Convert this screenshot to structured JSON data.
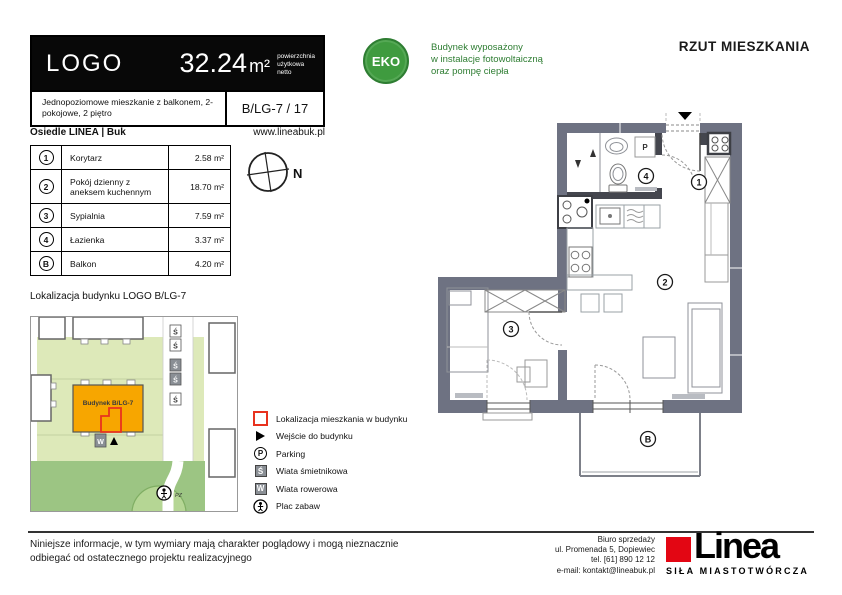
{
  "header": {
    "logo_text": "LOGO",
    "area": "32.24",
    "area_unit": "m²",
    "area_note_line1": "powierzchnia",
    "area_note_line2": "użytkowa",
    "area_note_line3": "netto",
    "description": "Jednopoziomowe mieszkanie z balkonem, 2-pokojowe, 2 piętro",
    "unit_code": "B/LG-7 / 17",
    "estate_name": "Osiedle LINEA | Buk",
    "website": "www.lineabuk.pl"
  },
  "eco": {
    "badge_text": "EKO",
    "line1": "Budynek wyposażony",
    "line2": "w instalacje fotowoltaiczną",
    "line3": "oraz pompę ciepła"
  },
  "plan_header": {
    "title": "RZUT MIESZKANIA"
  },
  "rooms_table": {
    "rows": [
      {
        "no": "1",
        "name": "Korytarz",
        "area": "2.58 m²"
      },
      {
        "no": "2",
        "name": "Pokój dzienny z aneksem kuchennym",
        "area": "18.70 m²"
      },
      {
        "no": "3",
        "name": "Sypialnia",
        "area": "7.59 m²"
      },
      {
        "no": "4",
        "name": "Łazienka",
        "area": "3.37 m²"
      },
      {
        "no": "B",
        "name": "Balkon",
        "area": "4.20 m²"
      }
    ]
  },
  "compass": {
    "north_label": "N"
  },
  "site_map": {
    "section_title": "Lokalizacja budynku  LOGO B/LG-7",
    "building_label": "Budynek B/LG-7",
    "waste_shelter_label": "Ś",
    "bike_shelter_label": "W",
    "playground_label": "PZ"
  },
  "legend": {
    "parking_icon_letter": "P",
    "waste_icon_letter": "Ś",
    "bike_icon_letter": "W",
    "items": [
      {
        "label": "Lokalizacja mieszkania w budynku"
      },
      {
        "label": "Wejście do budynku"
      },
      {
        "label": "Parking"
      },
      {
        "label": "Wiata śmietnikowa"
      },
      {
        "label": "Wiata rowerowa"
      },
      {
        "label": "Plac zabaw"
      }
    ]
  },
  "floor_plan": {
    "badge_corridor": "1",
    "badge_living": "2",
    "badge_bedroom": "3",
    "badge_bathroom": "4",
    "badge_balcony": "B",
    "washing_machine_label": "P"
  },
  "footer": {
    "disclaimer_line1": "Niniejsze informacje, w tym wymiary mają charakter poglądowy i mogą nieznacznie",
    "disclaimer_line2": "odbiegać od ostatecznego projektu realizacyjnego",
    "office_line1": "Biuro sprzedaży",
    "office_line2": "ul. Promenada 5, Dopiewiec",
    "office_line3": "tel. [61] 890 12 12",
    "office_line4": "e-mail: kontakt@lineabuk.pl",
    "brand_name": "Linea",
    "brand_tagline": "SIŁA MIASTOTWÓRCZA"
  },
  "colors": {
    "eco_green": "#3f9b3f",
    "brand_red": "#e30613",
    "wall_gray": "#6e7282",
    "map_plot_green": "#dde9b9",
    "map_park_green": "#9cc583",
    "building_orange": "#f7a600",
    "apartment_outline_red": "#e8321e"
  }
}
